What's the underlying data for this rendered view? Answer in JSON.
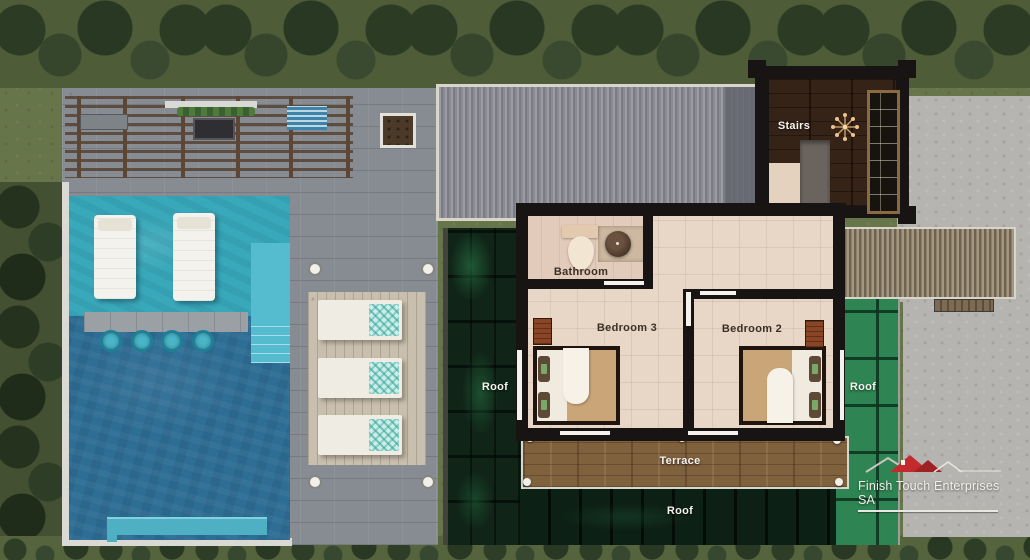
{
  "labels": {
    "stairs": "Stairs",
    "bathroom": "Bathroom",
    "bedroom3": "Bedroom 3",
    "bedroom2": "Bedroom 2",
    "terrace": "Terrace",
    "roof_left": "Roof",
    "roof_bottom": "Roof",
    "roof_right": "Roof"
  },
  "logo": {
    "text": "Finish Touch Enterprises SA",
    "accent_color": "#c22a2e"
  },
  "colors": {
    "pool_water": "#2e6d94",
    "shallow_water": "#39a8ba",
    "deck_gray": "#878c92",
    "green_roof_dark": "#102518",
    "green_roof_bright": "#2e8452",
    "interior_floor": "#e8d7c6",
    "wall_black": "#171413",
    "terrace_wood": "#80613d"
  }
}
